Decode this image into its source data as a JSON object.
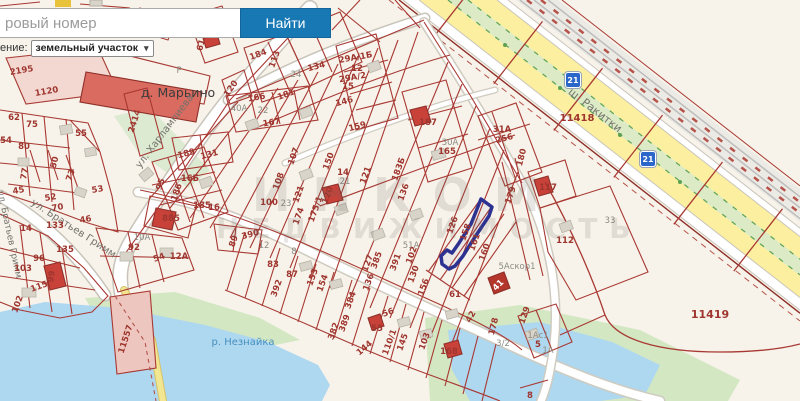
{
  "ui": {
    "search": {
      "placeholder_visible": "ровый номер",
      "button": "Найти"
    },
    "layer_select": {
      "label_visible": "ение:",
      "value": "земельный участок",
      "chevron": "▾"
    }
  },
  "badges": [
    {
      "label": "21"
    },
    {
      "label": "21"
    }
  ],
  "watermark": {
    "line1": "ИНКОМ",
    "line2": "НЕДВИЖИМОСТЬ"
  },
  "map": {
    "selected_parcel_color": "#2d3191",
    "colors": {
      "background": "#f7f3ea",
      "parcel_line": "#a83832",
      "water": "#aed7f0",
      "green": "#d3e7c3",
      "road_yellow": "#fcef9f",
      "median_green": "#dcebc6",
      "building_red": "#c8423a",
      "building_gray": "#d8d4ca",
      "accent_blue": "#1878b4"
    },
    "labels": [
      {
        "t": "д. Марьино",
        "x": 178,
        "y": 97,
        "r": 0,
        "k": "place"
      },
      {
        "t": "Р",
        "x": 179,
        "y": 73,
        "r": 0,
        "k": "gray"
      },
      {
        "t": "ул. Харлампиева",
        "x": 167,
        "y": 133,
        "r": -53,
        "k": "street"
      },
      {
        "t": "ул. Братьев Гримм",
        "x": 72,
        "y": 231,
        "r": 33,
        "k": "street"
      },
      {
        "t": "ул. Братьев Гримм",
        "x": 7,
        "y": 235,
        "r": 78,
        "k": "street",
        "s": 9
      },
      {
        "t": "ш. Ракитки",
        "x": 593,
        "y": 113,
        "r": 38,
        "k": "street",
        "s": 11
      },
      {
        "t": "р. Незнайка",
        "x": 243,
        "y": 345,
        "r": 0,
        "k": "water"
      },
      {
        "t": "33",
        "x": 610,
        "y": 223,
        "r": 0,
        "k": "gray"
      },
      {
        "t": "13",
        "x": 158,
        "y": 17,
        "r": 0
      },
      {
        "t": "6131",
        "x": 205,
        "y": 40,
        "r": -75
      },
      {
        "t": "2195",
        "x": 22,
        "y": 73,
        "r": -10
      },
      {
        "t": "1120",
        "x": 47,
        "y": 94,
        "r": -10
      },
      {
        "t": "2414",
        "x": 137,
        "y": 122,
        "r": -72
      },
      {
        "t": "62",
        "x": 14,
        "y": 120
      },
      {
        "t": "75",
        "x": 32,
        "y": 127
      },
      {
        "t": "54",
        "x": 6,
        "y": 143
      },
      {
        "t": "80",
        "x": 24,
        "y": 149
      },
      {
        "t": "55",
        "x": 81,
        "y": 136
      },
      {
        "t": "50",
        "x": 57,
        "y": 163,
        "r": -75
      },
      {
        "t": "73",
        "x": 73,
        "y": 176,
        "r": -70
      },
      {
        "t": "77",
        "x": 27,
        "y": 174,
        "r": -80
      },
      {
        "t": "45",
        "x": 19,
        "y": 193,
        "r": -10
      },
      {
        "t": "52",
        "x": 51,
        "y": 200,
        "r": -10
      },
      {
        "t": "70",
        "x": 58,
        "y": 210,
        "r": -10
      },
      {
        "t": "53",
        "x": 98,
        "y": 192,
        "r": -10
      },
      {
        "t": "46",
        "x": 86,
        "y": 222,
        "r": -10
      },
      {
        "t": "133",
        "x": 55,
        "y": 228
      },
      {
        "t": "14",
        "x": 26,
        "y": 231
      },
      {
        "t": "135",
        "x": 65,
        "y": 252
      },
      {
        "t": "96",
        "x": 39,
        "y": 261
      },
      {
        "t": "103",
        "x": 23,
        "y": 271
      },
      {
        "t": "99",
        "x": 54,
        "y": 277,
        "r": -80
      },
      {
        "t": "115",
        "x": 40,
        "y": 289,
        "r": -20
      },
      {
        "t": "102",
        "x": 20,
        "y": 305,
        "r": -70
      },
      {
        "t": "95",
        "x": 163,
        "y": 185,
        "r": -70
      },
      {
        "t": "16Б",
        "x": 190,
        "y": 181
      },
      {
        "t": "186",
        "x": 179,
        "y": 193,
        "r": -70
      },
      {
        "t": "185",
        "x": 202,
        "y": 208
      },
      {
        "t": "16",
        "x": 214,
        "y": 210
      },
      {
        "t": "189",
        "x": 187,
        "y": 156,
        "r": -15
      },
      {
        "t": "131",
        "x": 210,
        "y": 157,
        "r": -15
      },
      {
        "t": "885",
        "x": 171,
        "y": 221
      },
      {
        "t": "390",
        "x": 251,
        "y": 237,
        "r": -15
      },
      {
        "t": "89",
        "x": 236,
        "y": 242,
        "r": -70
      },
      {
        "t": "92",
        "x": 134,
        "y": 250
      },
      {
        "t": "10А",
        "x": 142,
        "y": 240,
        "k": "gray"
      },
      {
        "t": "54",
        "x": 160,
        "y": 260,
        "r": -20
      },
      {
        "t": "12А",
        "x": 179,
        "y": 259
      },
      {
        "t": "121",
        "x": 301,
        "y": 195,
        "r": -70
      },
      {
        "t": "121",
        "x": 368,
        "y": 176,
        "r": -70
      },
      {
        "t": "107",
        "x": 296,
        "y": 157,
        "r": -70
      },
      {
        "t": "108",
        "x": 281,
        "y": 182,
        "r": -70
      },
      {
        "t": "100",
        "x": 269,
        "y": 205
      },
      {
        "t": "23",
        "x": 286,
        "y": 206,
        "k": "gray"
      },
      {
        "t": "174",
        "x": 301,
        "y": 217,
        "r": -70
      },
      {
        "t": "175/1",
        "x": 318,
        "y": 210,
        "r": -70
      },
      {
        "t": "150",
        "x": 331,
        "y": 162,
        "r": -70
      },
      {
        "t": "14",
        "x": 343,
        "y": 175
      },
      {
        "t": "21",
        "x": 345,
        "y": 184,
        "k": "gray"
      },
      {
        "t": "159",
        "x": 358,
        "y": 129,
        "r": -15
      },
      {
        "t": "125",
        "x": 309,
        "y": 25,
        "r": -15
      },
      {
        "t": "134",
        "x": 317,
        "y": 69,
        "r": -15
      },
      {
        "t": "24",
        "x": 296,
        "y": 77,
        "k": "gray"
      },
      {
        "t": "184",
        "x": 259,
        "y": 57,
        "r": -20
      },
      {
        "t": "113",
        "x": 277,
        "y": 60,
        "r": -70
      },
      {
        "t": "120",
        "x": 233,
        "y": 90,
        "r": -55
      },
      {
        "t": "166",
        "x": 257,
        "y": 100,
        "r": -10
      },
      {
        "t": "181",
        "x": 287,
        "y": 97,
        "r": -20
      },
      {
        "t": "167",
        "x": 272,
        "y": 125,
        "r": -10
      },
      {
        "t": "40А",
        "x": 239,
        "y": 111,
        "k": "gray"
      },
      {
        "t": "22",
        "x": 263,
        "y": 113,
        "k": "gray"
      },
      {
        "t": "29А/1Б",
        "x": 356,
        "y": 60,
        "r": -10
      },
      {
        "t": "12",
        "x": 357,
        "y": 71
      },
      {
        "t": "29А/2",
        "x": 353,
        "y": 80,
        "r": -10
      },
      {
        "t": "15",
        "x": 348,
        "y": 89
      },
      {
        "t": "146",
        "x": 345,
        "y": 104,
        "r": -15
      },
      {
        "t": "187",
        "x": 428,
        "y": 125
      },
      {
        "t": "30А",
        "x": 450,
        "y": 145,
        "k": "gray"
      },
      {
        "t": "165",
        "x": 447,
        "y": 154
      },
      {
        "t": "31А",
        "x": 502,
        "y": 132
      },
      {
        "t": "256",
        "x": 505,
        "y": 141,
        "r": -15
      },
      {
        "t": "180",
        "x": 524,
        "y": 158,
        "r": -75
      },
      {
        "t": "179",
        "x": 513,
        "y": 196,
        "r": -70
      },
      {
        "t": "117",
        "x": 548,
        "y": 190
      },
      {
        "t": "112",
        "x": 565,
        "y": 243
      },
      {
        "t": "126",
        "x": 455,
        "y": 226,
        "r": -70
      },
      {
        "t": "158",
        "x": 468,
        "y": 233,
        "r": -70
      },
      {
        "t": "161",
        "x": 477,
        "y": 243,
        "r": -70
      },
      {
        "t": "160",
        "x": 487,
        "y": 253,
        "r": -70
      },
      {
        "t": "5Аскор1",
        "x": 517,
        "y": 269,
        "k": "gray"
      },
      {
        "t": "41",
        "x": 500,
        "y": 287,
        "r": -45,
        "k": "white"
      },
      {
        "t": "61",
        "x": 455,
        "y": 297
      },
      {
        "t": "42",
        "x": 473,
        "y": 318,
        "r": -60
      },
      {
        "t": "178",
        "x": 496,
        "y": 327,
        "r": -75
      },
      {
        "t": "3/2",
        "x": 503,
        "y": 346,
        "k": "gray"
      },
      {
        "t": "129",
        "x": 527,
        "y": 316,
        "r": -70
      },
      {
        "t": "1Ас1",
        "x": 538,
        "y": 338,
        "k": "gray"
      },
      {
        "t": "5",
        "x": 538,
        "y": 347
      },
      {
        "t": "1А",
        "x": 548,
        "y": 353,
        "k": "gray"
      },
      {
        "t": "11419",
        "x": 710,
        "y": 318,
        "s": 11
      },
      {
        "t": "8",
        "x": 530,
        "y": 398
      },
      {
        "t": "11418",
        "x": 577,
        "y": 121,
        "s": 10
      },
      {
        "t": "11557",
        "x": 128,
        "y": 340,
        "r": -72
      },
      {
        "t": "120",
        "x": 330,
        "y": 196,
        "r": -70
      },
      {
        "t": "136",
        "x": 406,
        "y": 193,
        "r": -70
      },
      {
        "t": "183Б",
        "x": 401,
        "y": 170,
        "r": -70
      },
      {
        "t": "127",
        "x": 370,
        "y": 264,
        "r": -70
      },
      {
        "t": "385",
        "x": 379,
        "y": 261,
        "r": -70
      },
      {
        "t": "391",
        "x": 398,
        "y": 263,
        "r": -70
      },
      {
        "t": "130",
        "x": 416,
        "y": 275,
        "r": -70
      },
      {
        "t": "156",
        "x": 426,
        "y": 288,
        "r": -70
      },
      {
        "t": "136",
        "x": 371,
        "y": 283,
        "r": -70
      },
      {
        "t": "83",
        "x": 273,
        "y": 267
      },
      {
        "t": "87",
        "x": 292,
        "y": 277
      },
      {
        "t": "392",
        "x": 279,
        "y": 289,
        "r": -70
      },
      {
        "t": "153",
        "x": 315,
        "y": 278,
        "r": -70
      },
      {
        "t": "154",
        "x": 325,
        "y": 284,
        "r": -70
      },
      {
        "t": "384",
        "x": 353,
        "y": 301,
        "r": -70
      },
      {
        "t": "389",
        "x": 347,
        "y": 324,
        "r": -70
      },
      {
        "t": "382",
        "x": 336,
        "y": 332,
        "r": -70
      },
      {
        "t": "144",
        "x": 366,
        "y": 350,
        "r": -40
      },
      {
        "t": "55",
        "x": 377,
        "y": 331
      },
      {
        "t": "56",
        "x": 389,
        "y": 315,
        "r": -20
      },
      {
        "t": "110/1",
        "x": 392,
        "y": 343,
        "r": -70
      },
      {
        "t": "145",
        "x": 405,
        "y": 343,
        "r": -70
      },
      {
        "t": "103",
        "x": 427,
        "y": 342,
        "r": -70
      },
      {
        "t": "168",
        "x": 449,
        "y": 354
      },
      {
        "t": "51А",
        "x": 411,
        "y": 248,
        "k": "gray"
      },
      {
        "t": "102",
        "x": 414,
        "y": 256,
        "r": -70
      },
      {
        "t": "12",
        "x": 264,
        "y": 248,
        "k": "gray"
      },
      {
        "t": "8",
        "x": 294,
        "y": 254,
        "k": "gray"
      }
    ]
  }
}
